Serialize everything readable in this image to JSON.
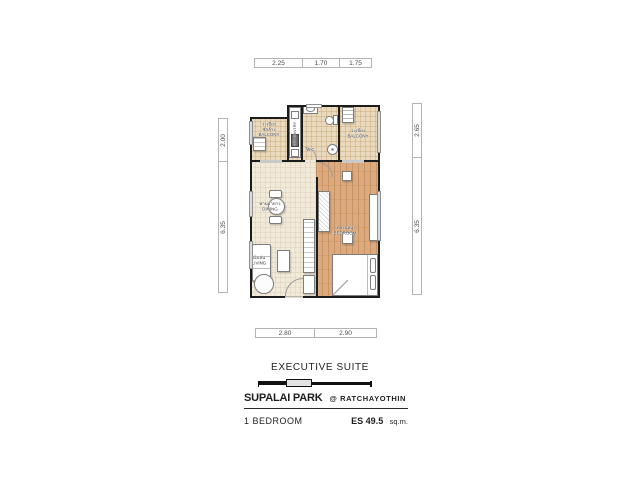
{
  "plan": {
    "dimensions": {
      "top": [
        "2.25",
        "1.70",
        "1.75"
      ],
      "bottom": [
        "2.80",
        "2.90"
      ],
      "left": [
        "2.00",
        "6.35"
      ],
      "right": [
        "2.65",
        "6.35"
      ]
    },
    "rooms": {
      "balcony_left": {
        "thai_line1": "ระเบียง",
        "thai_line2": "ซักล้าง",
        "label": "BALCONY"
      },
      "pantry": {
        "thai": "ครัว",
        "label": "PANTRY"
      },
      "wc": {
        "label": "W.C."
      },
      "balcony_right": {
        "thai": "ระเบียง",
        "label": "BALCONY"
      },
      "dining": {
        "thai": "ทานอาหาร",
        "label": "DINING"
      },
      "living": {
        "thai": "นั่งเล่น",
        "label": "LIVING"
      },
      "bedroom": {
        "thai": "ห้องนอน",
        "label": "BEDROOM"
      }
    }
  },
  "title_block": {
    "suite_name": "EXECUTIVE SUITE",
    "project_name": "SUPALAI PARK",
    "project_location": "@ RATCHAYOTHIN",
    "unit_type": "1 BEDROOM",
    "area_label": "ES 49.5",
    "area_unit": "sq.m."
  },
  "colors": {
    "wall": "#1c1c1c",
    "tile_floor": "#ead9bc",
    "living_floor": "#f1ead9",
    "wood_floor": "#dcaa7e"
  }
}
